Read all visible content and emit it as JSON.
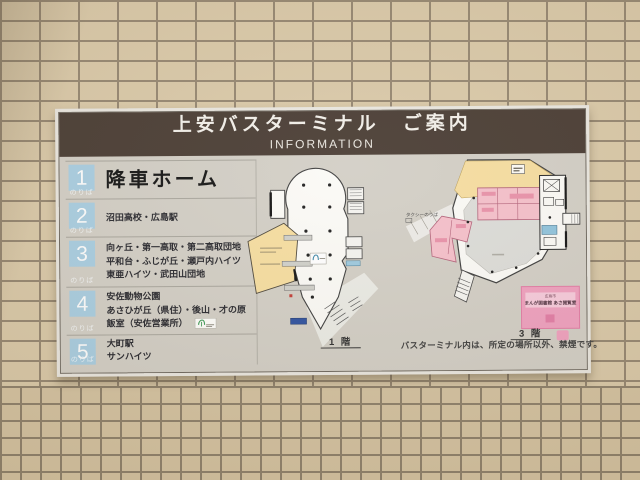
{
  "sign": {
    "title": "上安バスターミナル　ご案内",
    "subtitle": "INFORMATION",
    "platforms": [
      {
        "number": "1",
        "platform_word": "のりば",
        "lines": [
          "降車ホーム"
        ]
      },
      {
        "number": "2",
        "platform_word": "のりば",
        "lines": [
          "沼田高校・広島駅"
        ]
      },
      {
        "number": "3",
        "platform_word": "のりば",
        "lines": [
          "向ヶ丘・第一高取・第二高取団地",
          "平和台・ふじが丘・瀬戸内ハイツ",
          "東亜ハイツ・武田山団地"
        ]
      },
      {
        "number": "4",
        "platform_word": "のりば",
        "lines": [
          "安佐動物公園",
          "あさひが丘（県住）・後山・才の原",
          "飯室（安佐営業所）"
        ]
      },
      {
        "number": "5",
        "platform_word": "のりば",
        "lines": [
          "大町駅",
          "サンハイツ"
        ]
      }
    ],
    "plans": {
      "floor1_label": "1 階",
      "floor3_label": "3 階",
      "taxi_stand_label": "タクシーのりば",
      "manga_library": {
        "line1": "広島市",
        "line2": "まんが図書館 あさ閲覧室"
      },
      "smoking_note": "バスターミナル内は、所定の場所以外、禁煙です。"
    },
    "colors": {
      "header_bg": "#473a31",
      "number_tile": "#a8cde1",
      "plan_yellow": "#f6dd9f",
      "plan_pink": "#f5bfca",
      "library_pink": "#ef9fbe",
      "wall_tile": "#d9c8a7"
    }
  }
}
